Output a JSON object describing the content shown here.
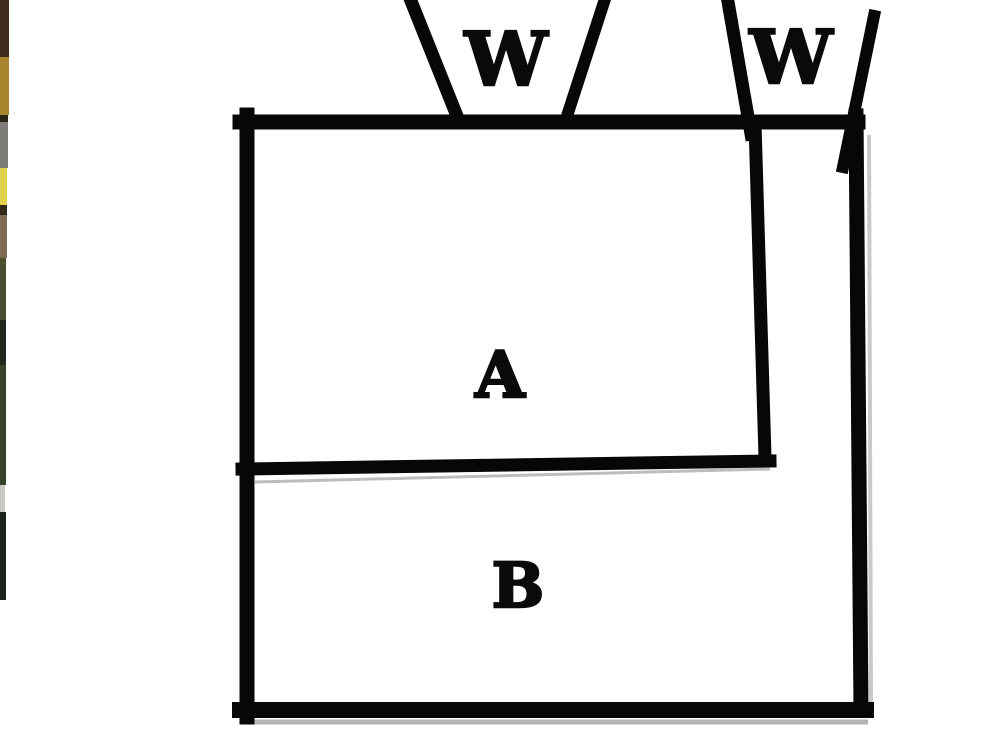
{
  "labels": {
    "left_funnel": "W",
    "right_funnel": "W",
    "region_a": "A",
    "region_b": "B"
  },
  "colors": {
    "background": "#ffffff",
    "line": "#070707",
    "label_text": "#0a0a0a",
    "bottom_shadow": "#b4b4b4",
    "right_shadow": "#c9c9c9",
    "divider_shadow": "#bdbdbd"
  },
  "photo_strip": {
    "segments": [
      {
        "y": 0,
        "h": 57,
        "w": 9,
        "color": "#3f2d20"
      },
      {
        "y": 57,
        "h": 58,
        "w": 9,
        "color": "#a8862f"
      },
      {
        "y": 115,
        "h": 7,
        "w": 8,
        "color": "#2b2518"
      },
      {
        "y": 122,
        "h": 46,
        "w": 8,
        "color": "#7d7c78"
      },
      {
        "y": 168,
        "h": 37,
        "w": 7,
        "color": "#e0d14b"
      },
      {
        "y": 205,
        "h": 10,
        "w": 7,
        "color": "#33291b"
      },
      {
        "y": 215,
        "h": 43,
        "w": 7,
        "color": "#7d6a52"
      },
      {
        "y": 258,
        "h": 62,
        "w": 6,
        "color": "#4a4f30"
      },
      {
        "y": 320,
        "h": 45,
        "w": 6,
        "color": "#23281e"
      },
      {
        "y": 365,
        "h": 120,
        "w": 6,
        "color": "#39422c"
      },
      {
        "y": 485,
        "h": 27,
        "w": 5,
        "color": "#c9c9c2"
      },
      {
        "y": 512,
        "h": 88,
        "w": 6,
        "color": "#1e221c"
      }
    ]
  }
}
